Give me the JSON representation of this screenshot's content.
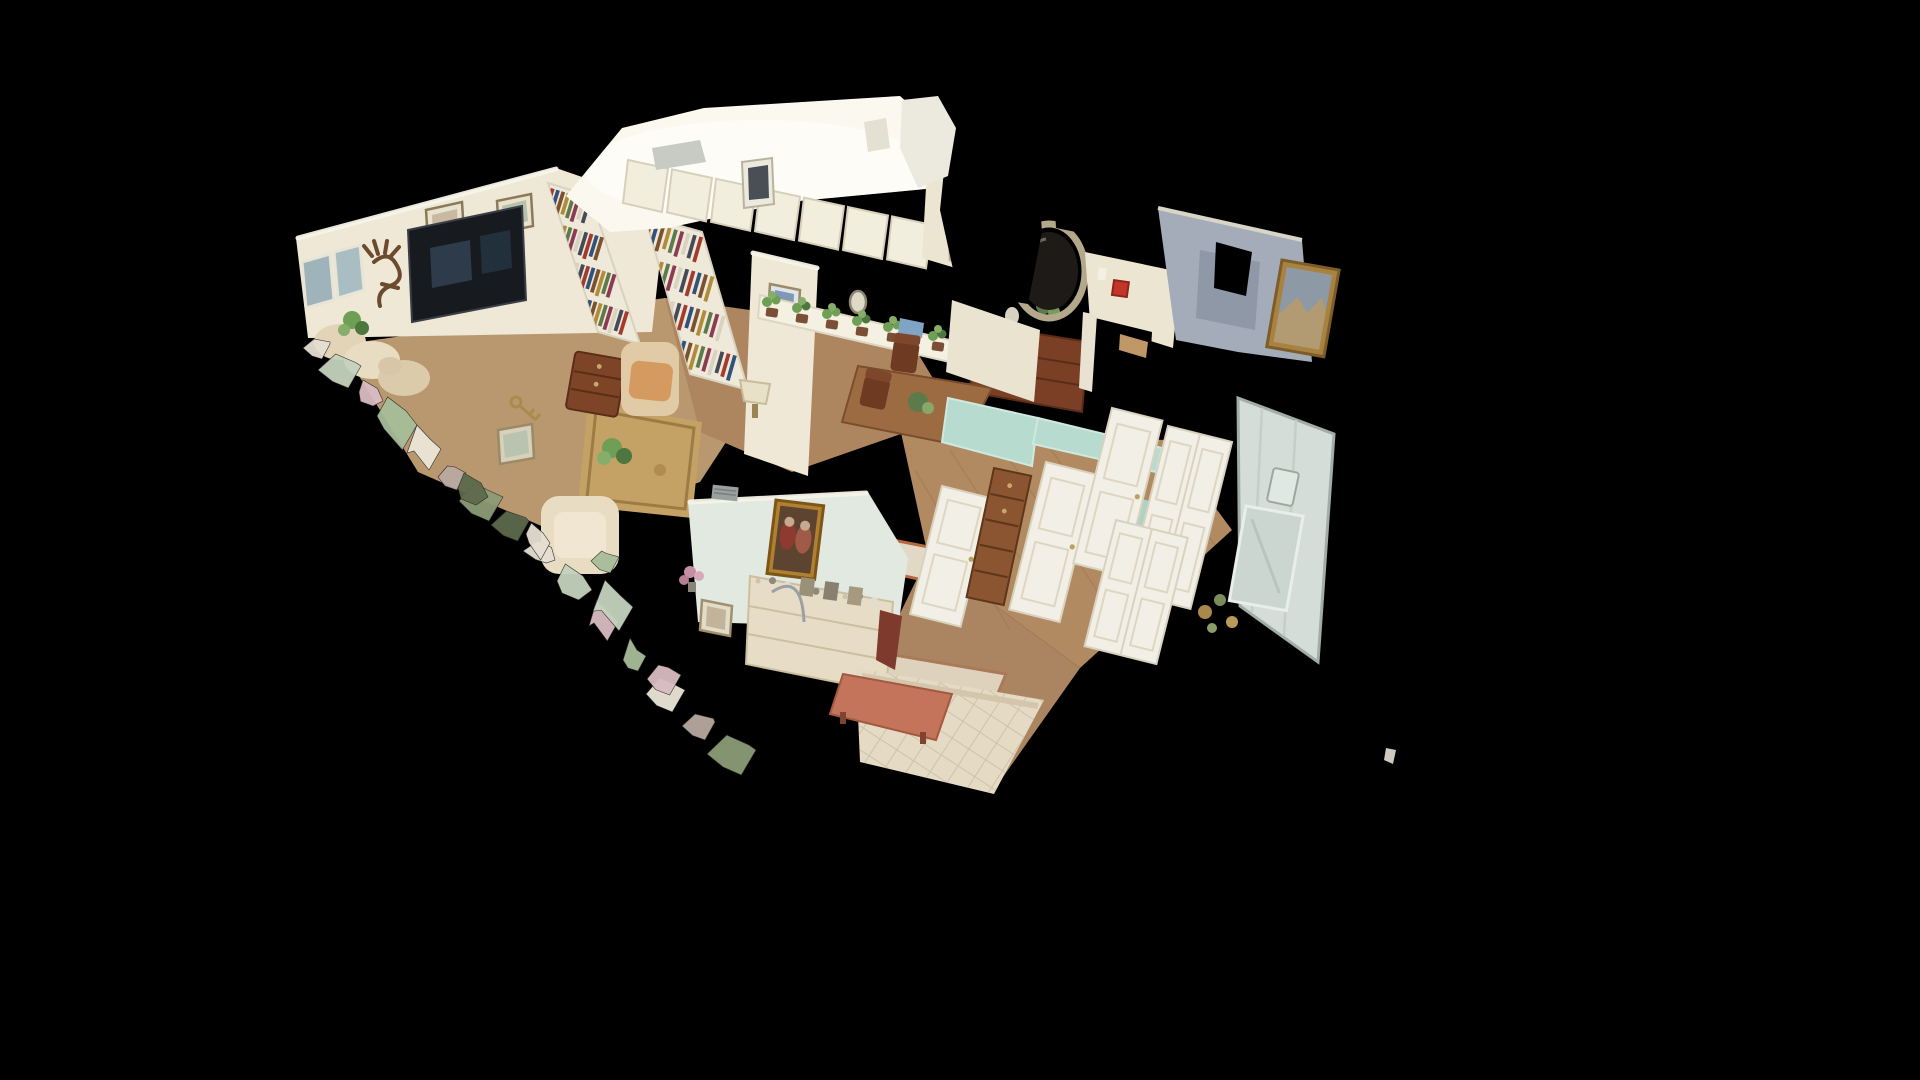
{
  "app": {
    "name": "3d-dollhouse-viewer",
    "background": "#000000",
    "view_mode_label": "Dollhouse"
  },
  "scene": {
    "kind": "residential-interior-3d-scan-cutaway",
    "rooms": {
      "model": {
        "label": "3D dollhouse model of furnished home"
      },
      "living": {
        "label": "Living room with TV and sofa"
      },
      "den": {
        "label": "Den library with bookshelves and armchairs"
      },
      "kitchen": {
        "label": "Kitchen with white cabinets"
      },
      "dining": {
        "label": "Dining area with buffet and oval mirror"
      },
      "hallway": {
        "label": "Hallway with white closet doors"
      },
      "bathroom": {
        "label": "Bathroom with glass shower"
      },
      "bedroom": {
        "label": "Bedroom with quilted bed and dresser"
      }
    },
    "palette": {
      "background": "#000000",
      "wall_cream": "#efe8d6",
      "wall_cream_bright": "#fbf9ef",
      "wall_pale_green": "#e2e9e1",
      "wall_gray_blue": "#a3acb8",
      "cut_top_mint": "#b7dbce",
      "cut_top_white": "#f6f3e8",
      "floor_wood": "#b28a62",
      "floor_wood_dark": "#9c7750",
      "rug_gold": "#c4a266",
      "rug_ivory": "#e2d8c6",
      "rug_red_border": "#b5693f",
      "quilt_cream": "#e5dac4",
      "quilt_line": "#c9bca0",
      "bench_salmon": "#c3745a",
      "wood_furniture": "#7b3f25",
      "wood_chest": "#8a5530",
      "tv_screen": "#171b20",
      "mirror_glass": "#1e1a17",
      "mirror_frame": "#b3a88b",
      "fire_alarm_red": "#c23527",
      "plant_green": "#6f9e55",
      "plant_green_dark": "#4e7740",
      "pot_brown": "#7b4f35",
      "shower_glass": "#e2ebe5",
      "glass_frame": "#aeb8b2",
      "painting_gold": "#a9823f",
      "door_white": "#f2efe6",
      "book_colors": [
        "#a23b2e",
        "#32527b",
        "#7a5230",
        "#b08c3a",
        "#5d7a4a",
        "#8c3b52",
        "#d9d2c0",
        "#444a57"
      ],
      "fragment_colors": [
        "#e6dfd2",
        "#c5d2bd",
        "#d9bcc2",
        "#a8bd9a",
        "#ece6d8",
        "#b9a9a0",
        "#8d9c77",
        "#5d6a4c"
      ]
    }
  }
}
